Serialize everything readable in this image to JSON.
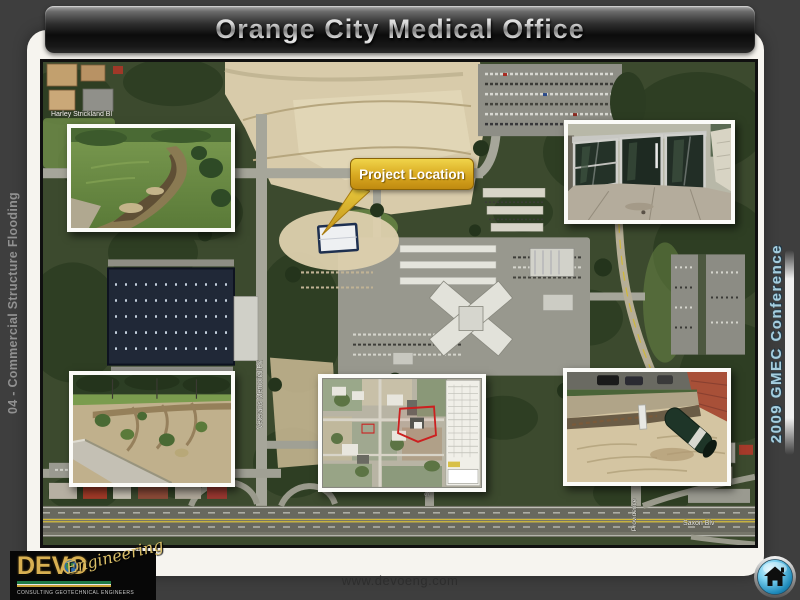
{
  "slide": {
    "title": "Orange City Medical Office",
    "left_rail_text": "04 - Commercial Structure Flooding",
    "right_rail_text": "2009 GMEC Conference",
    "footer_url": "www.devoeng.com"
  },
  "map": {
    "callout_label": "Project Location",
    "street_labels": {
      "harley": "Harley Strickland Bl",
      "veterans": "Veterans Memorial Pk",
      "saville": "Saville",
      "saxon": "Saxon Blv",
      "providence": "Providence"
    },
    "insets": [
      {
        "name": "flooded-swale-photo"
      },
      {
        "name": "storefront-doors-photo"
      },
      {
        "name": "eroded-embankment-photo"
      },
      {
        "name": "site-plan-aerial-photo"
      },
      {
        "name": "exposed-pipe-excavation-photo"
      }
    ]
  },
  "logo": {
    "name": "DEVO",
    "script": "Engineering",
    "tagline": "CONSULTING GEOTECHNICAL ENGINEERS"
  },
  "colors": {
    "callout_gold": "#d8a820",
    "home_button_blue": "#1d88b8",
    "rail_blue_text": "#a6cede",
    "logo_gold": "#d8b052"
  }
}
